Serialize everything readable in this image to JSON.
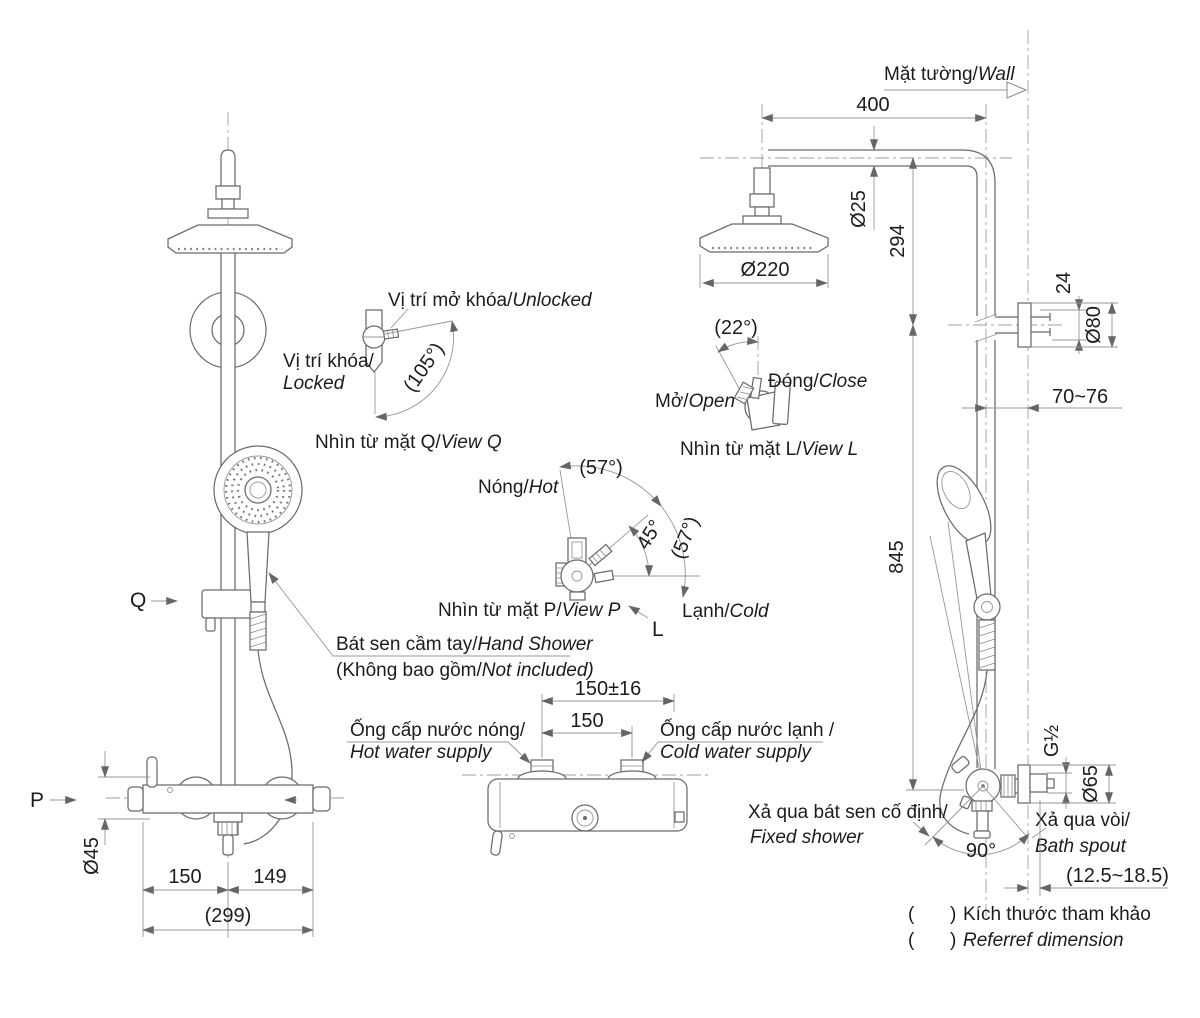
{
  "colors": {
    "line": "#6b6b6b",
    "thin": "#979797",
    "text": "#1c1c1c",
    "background": "#ffffff"
  },
  "labels": {
    "wall_vi": "Mặt tường/",
    "wall_en": "Wall",
    "q_marker": "Q",
    "p_marker": "P",
    "l_marker": "L",
    "hand_shower_vi": "Bát sen cầm tay/",
    "hand_shower_en": "Hand Shower",
    "not_included_vi": "(Không bao gồm/",
    "not_included_en": "Not included)",
    "hot_supply_vi": "Ống cấp nước nóng/",
    "hot_supply_en": "Hot water supply",
    "cold_supply_vi": "Ống cấp nước lạnh /",
    "cold_supply_en": "Cold water supply",
    "fixed_shower_vi": "Xả qua bát sen cố định/",
    "fixed_shower_en": "Fixed shower",
    "bath_spout_vi": "Xả qua vòi/",
    "bath_spout_en": "Bath spout"
  },
  "views": {
    "q": {
      "unlocked_vi": "Vị trí mở khóa/",
      "unlocked_en": "Unlocked",
      "locked_vi": "Vị trí khóa/",
      "locked_en": "Locked",
      "angle": "(105°)",
      "title_vi": "Nhìn từ mặt Q/",
      "title_en": "View Q"
    },
    "l": {
      "angle": "(22°)",
      "open_vi": "Mở/",
      "open_en": "Open",
      "close_vi": "Đóng/",
      "close_en": "Close",
      "title_vi": "Nhìn từ mặt L/",
      "title_en": "View L"
    },
    "p": {
      "angle_top": "(57°)",
      "angle_right": "(57°)",
      "angle_mid": "45°",
      "hot_vi": "Nóng/",
      "hot_en": "Hot",
      "cold_vi": "Lạnh/",
      "cold_en": "Cold",
      "title_vi": "Nhìn từ mặt P/",
      "title_en": "View P"
    }
  },
  "dims": {
    "arm_reach": "400",
    "arm_dia": "Ø25",
    "head_drop": "294",
    "head_dia": "Ø220",
    "bracket_pin": "24",
    "bracket_dia": "Ø80",
    "wall_offset": "70~76",
    "bar_height": "845",
    "thread": "G½",
    "valve_flange_dia": "Ø65",
    "swivel": "90°",
    "wall_gap": "(12.5~18.5)",
    "inlet_tol": "150±16",
    "inlet_span": "150",
    "valve_dia": "Ø45",
    "left_span": "150",
    "right_span": "149",
    "total_span": "(299)"
  },
  "notes": {
    "open": "(",
    "close": ")",
    "line1": "Kích thước tham khảo",
    "line2": "Referref dimension"
  }
}
